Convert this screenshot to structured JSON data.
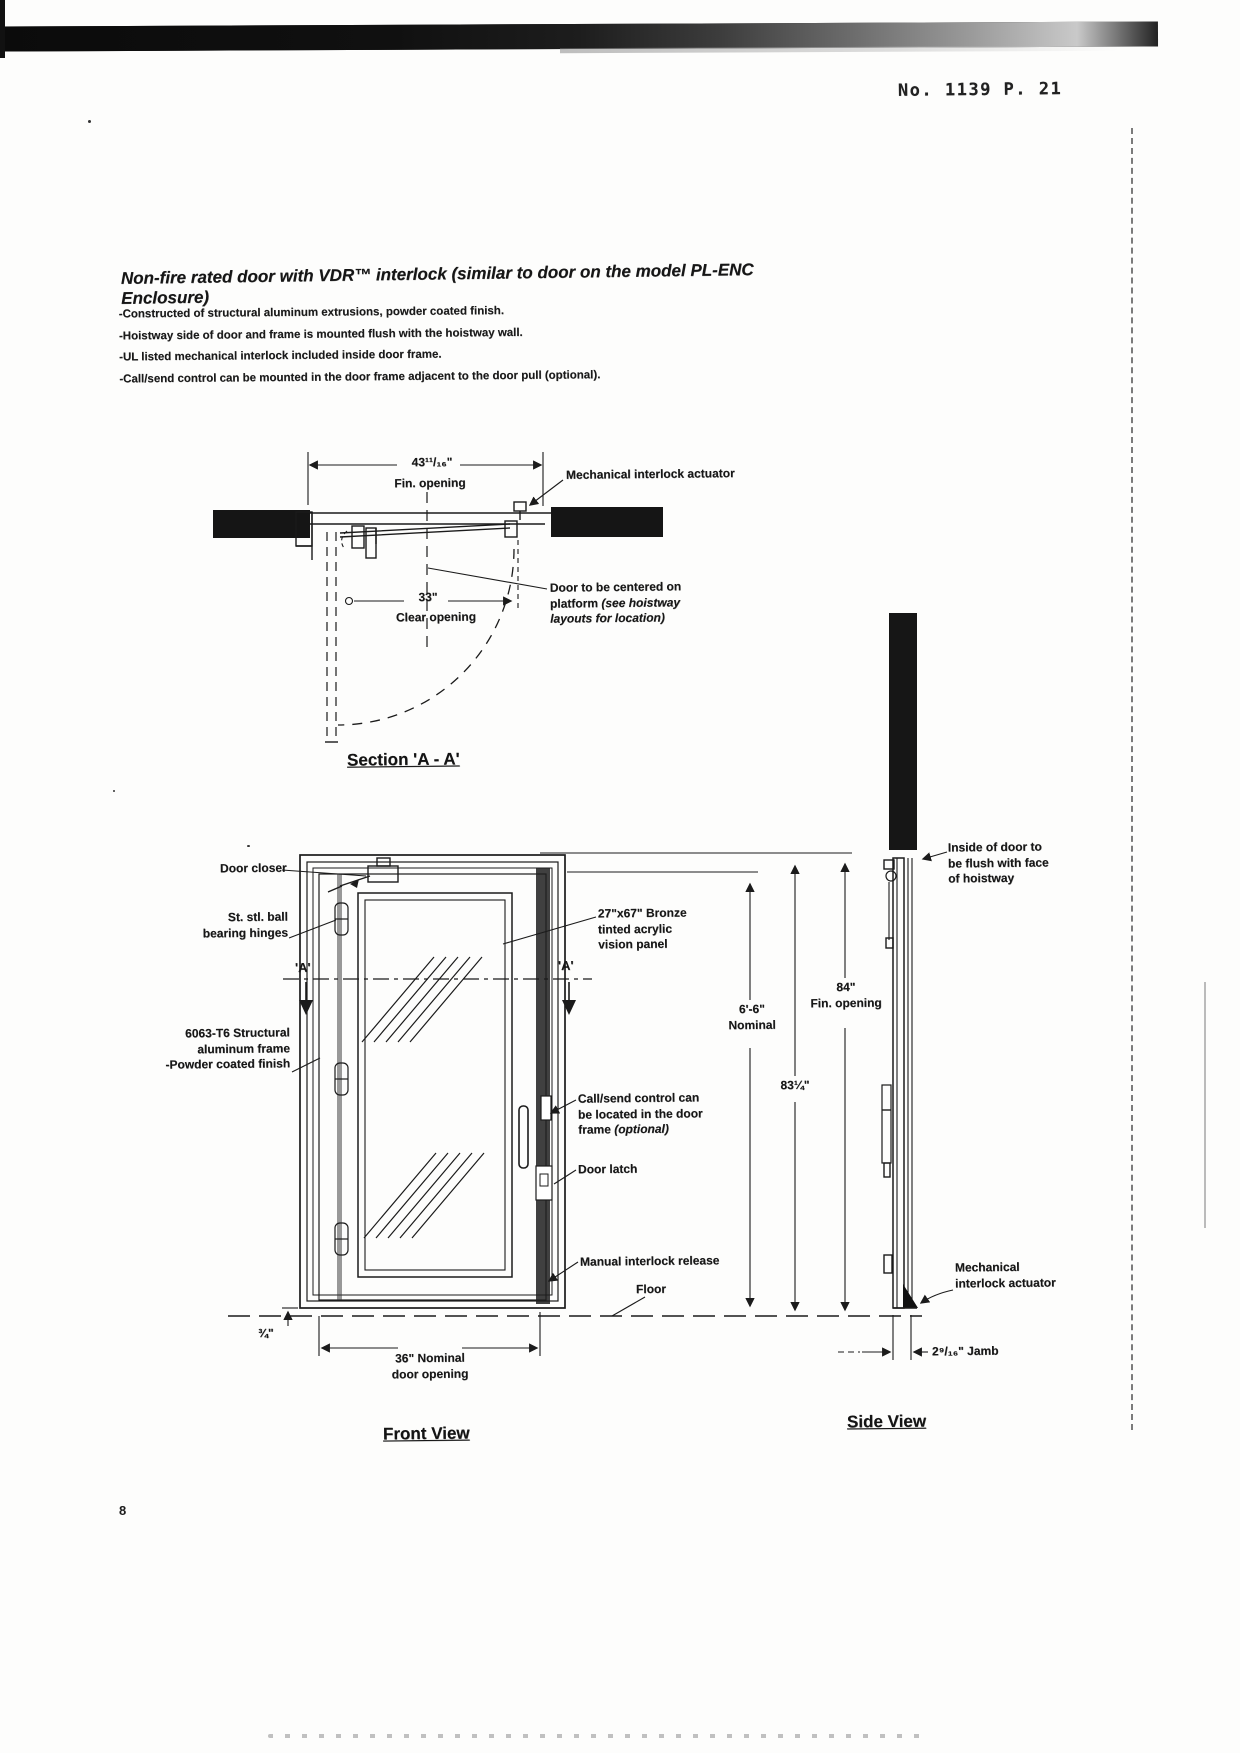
{
  "fax": {
    "header": "No. 1139   P. 21",
    "page_number": "8"
  },
  "title": "Non-fire rated door with VDR™ interlock (similar to door on the model PL-ENC Enclosure)",
  "bullets": [
    "-Constructed of structural aluminum extrusions, powder coated finish.",
    "-Hoistway side of door and frame is mounted flush with the hoistway wall.",
    "-UL listed mechanical interlock included inside door frame.",
    "-Call/send control can be mounted in the door frame adjacent to the door pull (optional)."
  ],
  "section_view": {
    "caption": "Section 'A - A'",
    "fin_opening_dim": "43¹¹/₁₆\"",
    "fin_opening_label": "Fin. opening",
    "clear_opening_dim": "33\"",
    "clear_opening_label": "Clear opening",
    "interlock_callout": "Mechanical interlock actuator",
    "centered_callout_1": "Door to be centered on",
    "centered_callout_2": "platform ",
    "centered_callout_2i": "(see hoistway",
    "centered_callout_3i": "layouts for location)"
  },
  "front_view": {
    "caption": "Front View",
    "door_closer": "Door closer",
    "hinges_1": "St. stl. ball",
    "hinges_2": "bearing hinges",
    "section_marker_left": "'A'",
    "section_marker_right": "'A'",
    "frame_1": "6063-T6 Structural",
    "frame_2": "aluminum frame",
    "frame_3": "-Powder coated finish",
    "vision_1": "27\"x67\" Bronze",
    "vision_2": "tinted acrylic",
    "vision_3": "vision panel",
    "callsend_1": "Call/send control can",
    "callsend_2": "be located in the door",
    "callsend_3": "frame ",
    "callsend_3i": "(optional)",
    "door_latch": "Door latch",
    "manual_release": "Manual interlock release",
    "floor": "Floor",
    "nominal_height_1": "6'-6\"",
    "nominal_height_2": "Nominal",
    "frame_height_dim": "83¼\"",
    "bottom_offset_dim": "¾\"",
    "door_opening_1": "36\" Nominal",
    "door_opening_2": "door opening"
  },
  "side_view": {
    "caption": "Side View",
    "fin_opening_1": "84\"",
    "fin_opening_2": "Fin. opening",
    "flush_1": "Inside of door to",
    "flush_2": "be flush with face",
    "flush_3": "of hoistway",
    "interlock_1": "Mechanical",
    "interlock_2": "interlock actuator",
    "jamb_dim": "2⁹/₁₆\" Jamb"
  }
}
